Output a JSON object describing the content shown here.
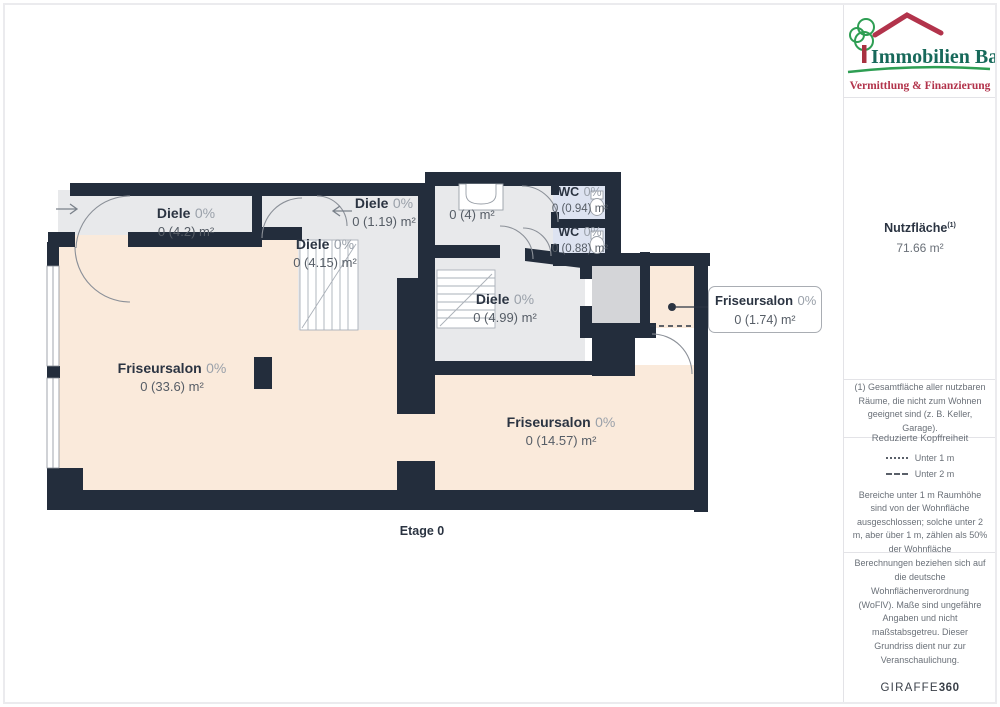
{
  "branding": {
    "name": "Immobilien Bart",
    "tagline": "Vermittlung & Finanzierung"
  },
  "floorplan": {
    "floor_label": "Etage 0",
    "rooms": [
      {
        "name": "Diele",
        "percent": "0%",
        "area": "0 (4.2) m²"
      },
      {
        "name": "Diele",
        "percent": "0%",
        "area": "0 (1.19) m²"
      },
      {
        "name": "Diele",
        "percent": "0%",
        "area": "0 (4.15) m²"
      },
      {
        "name": "",
        "percent": "",
        "area": "0 (4) m²"
      },
      {
        "name": "WC",
        "percent": "0%",
        "area": "0 (0.94) m²"
      },
      {
        "name": "WC",
        "percent": "0%",
        "area": "0 (0.88) m²"
      },
      {
        "name": "Diele",
        "percent": "0%",
        "area": "0 (4.99) m²"
      },
      {
        "name": "Friseursalon",
        "percent": "0%",
        "area": "0 (33.6) m²"
      },
      {
        "name": "Friseursalon",
        "percent": "0%",
        "area": "0 (14.57) m²"
      },
      {
        "name": "Friseursalon",
        "percent": "0%",
        "area": "0 (1.74) m²"
      }
    ]
  },
  "sidebar": {
    "area_label": "Nutzfläche",
    "area_superscript": "(1)",
    "area_value": "71.66 m²",
    "footnote": "(1) Gesamtfläche aller nutzbaren Räume, die nicht zum Wohnen geeignet sind (z. B. Keller, Garage).",
    "headroom": {
      "title": "Reduzierte Kopffreiheit",
      "legend_under_1m": "Unter 1 m",
      "legend_under_2m": "Unter 2 m",
      "note": "Bereiche unter 1 m Raumhöhe sind von der Wohnfläche ausgeschlossen; solche unter 2 m, aber über 1 m, zählen als 50% der Wohnfläche"
    },
    "disclaimer": "Berechnungen beziehen sich auf die deutsche Wohnflächenverordnung (WoFlV). Maße sind ungefähre Angaben und nicht maßstabsgetreu. Dieser Grundriss dient nur zur Veranschaulichung.",
    "brand_word": "GIRAFFE",
    "brand_number": "360"
  },
  "colors": {
    "wall": "#232d3c",
    "floor_gray": "#e8e9eb",
    "floor_peach": "#faeadb",
    "floor_wc": "#dde3f1",
    "floor_storage": "#d4d5d8",
    "door_line": "#8b9098",
    "label_dark": "#2b3442",
    "label_gray": "#9aa1aa",
    "logo_green": "#17695a",
    "logo_red": "#b2334b",
    "tree_green": "#2e9e53"
  }
}
